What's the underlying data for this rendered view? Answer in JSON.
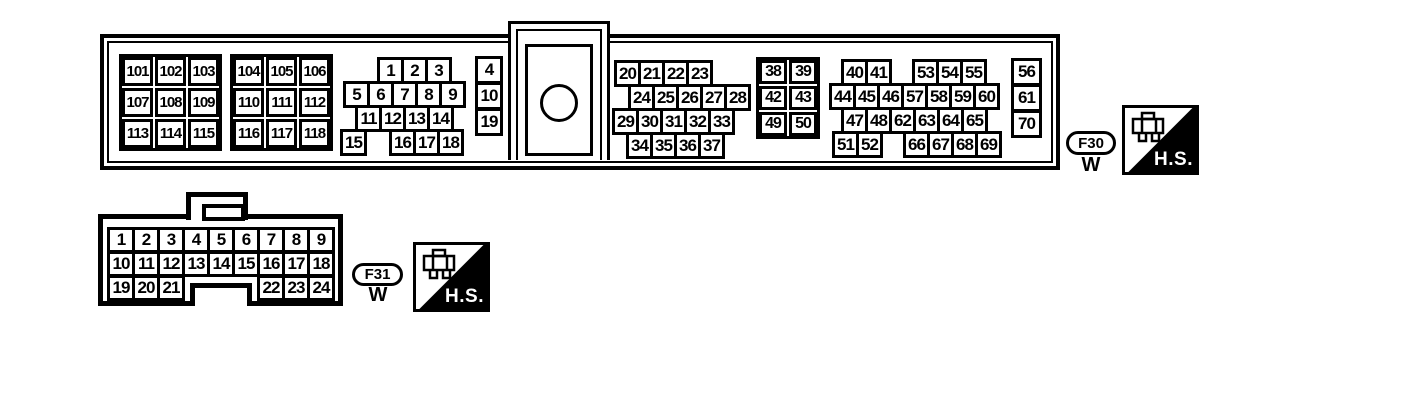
{
  "page": {
    "background": "#ffffff",
    "ink": "#000000"
  },
  "hs": {
    "label": "H.S."
  },
  "f30": {
    "label": "F30",
    "color": "W",
    "g1": [
      "101",
      "102",
      "103",
      "107",
      "108",
      "109",
      "113",
      "114",
      "115"
    ],
    "g2": [
      "104",
      "105",
      "106",
      "110",
      "111",
      "112",
      "116",
      "117",
      "118"
    ],
    "r1": [
      "1",
      "2",
      "3"
    ],
    "r2": [
      "5",
      "6",
      "7",
      "8",
      "9"
    ],
    "r3": [
      "11",
      "12",
      "13",
      "14"
    ],
    "r4a": [
      "15"
    ],
    "r4b": [
      "16",
      "17",
      "18"
    ],
    "c1": [
      "4",
      "10",
      "19"
    ],
    "r5": [
      "20",
      "21",
      "22",
      "23"
    ],
    "r6": [
      "24",
      "25",
      "26",
      "27",
      "28"
    ],
    "r7": [
      "29",
      "30",
      "31",
      "32",
      "33"
    ],
    "r8": [
      "34",
      "35",
      "36",
      "37"
    ],
    "g3": [
      "38",
      "39",
      "42",
      "43",
      "49",
      "50"
    ],
    "r9a": [
      "40",
      "41"
    ],
    "r9b": [
      "53",
      "54",
      "55"
    ],
    "r10": [
      "44",
      "45",
      "46",
      "57",
      "58",
      "59",
      "60"
    ],
    "r11": [
      "47",
      "48",
      "62",
      "63",
      "64",
      "65"
    ],
    "r12a": [
      "51",
      "52"
    ],
    "r12b": [
      "66",
      "67",
      "68",
      "69"
    ],
    "c2": [
      "56",
      "61",
      "70"
    ]
  },
  "f31": {
    "label": "F31",
    "color": "W",
    "r1": [
      "1",
      "2",
      "3",
      "4",
      "5",
      "6",
      "7",
      "8",
      "9"
    ],
    "r2": [
      "10",
      "11",
      "12",
      "13",
      "14",
      "15",
      "16",
      "17",
      "18"
    ],
    "r3a": [
      "19",
      "20",
      "21"
    ],
    "r3b": [
      "22",
      "23",
      "24"
    ]
  }
}
